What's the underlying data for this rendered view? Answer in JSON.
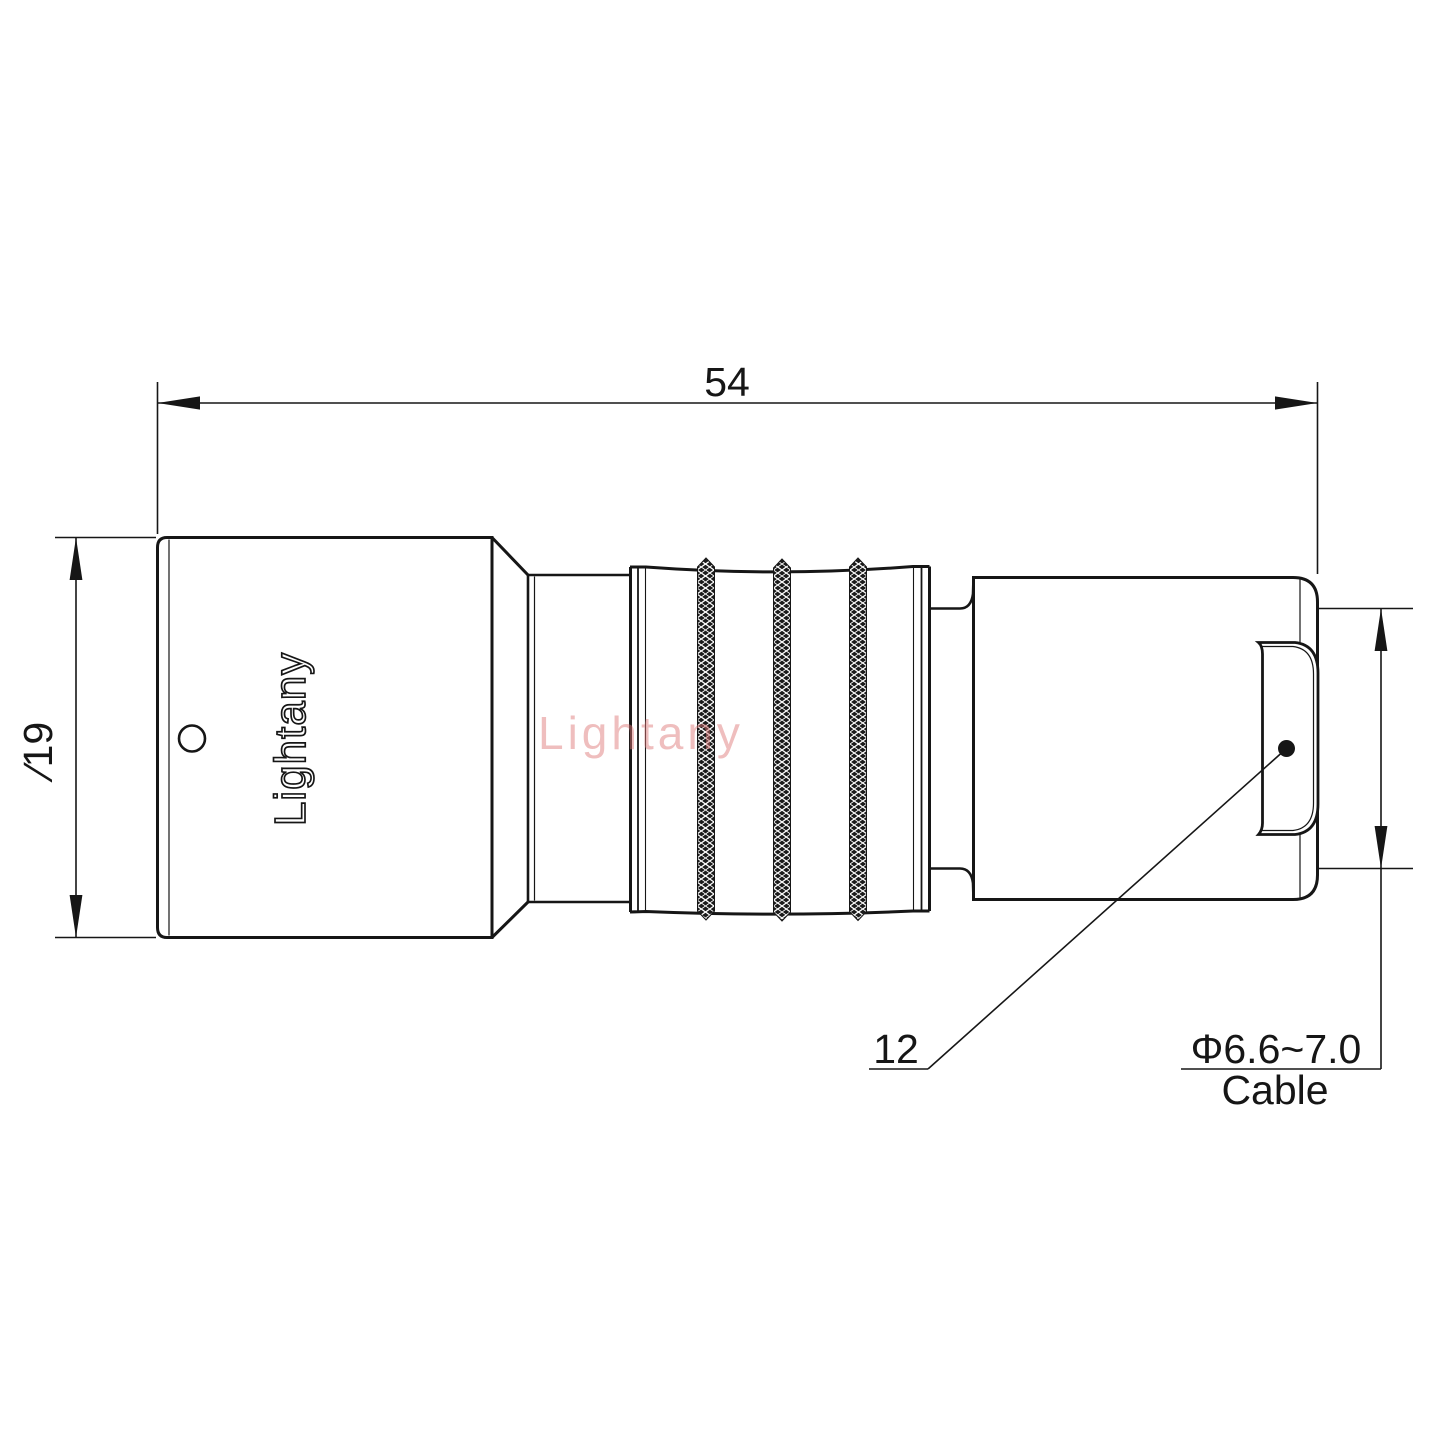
{
  "drawing": {
    "title": "connector technical drawing",
    "dimensions": {
      "overall_length": "54",
      "body_diameter": "∕19",
      "cable_diameter_range": "Φ6.6~7.0",
      "cable_caption": "Cable",
      "callout_item": "12"
    },
    "branding": {
      "engraved_logo": "Lightany",
      "watermark": "Lightany"
    },
    "colors": {
      "line": "#161616",
      "knurl_fill": "#1b1b1b",
      "watermark_pink": "#de7878",
      "background": "#ffffff"
    }
  }
}
